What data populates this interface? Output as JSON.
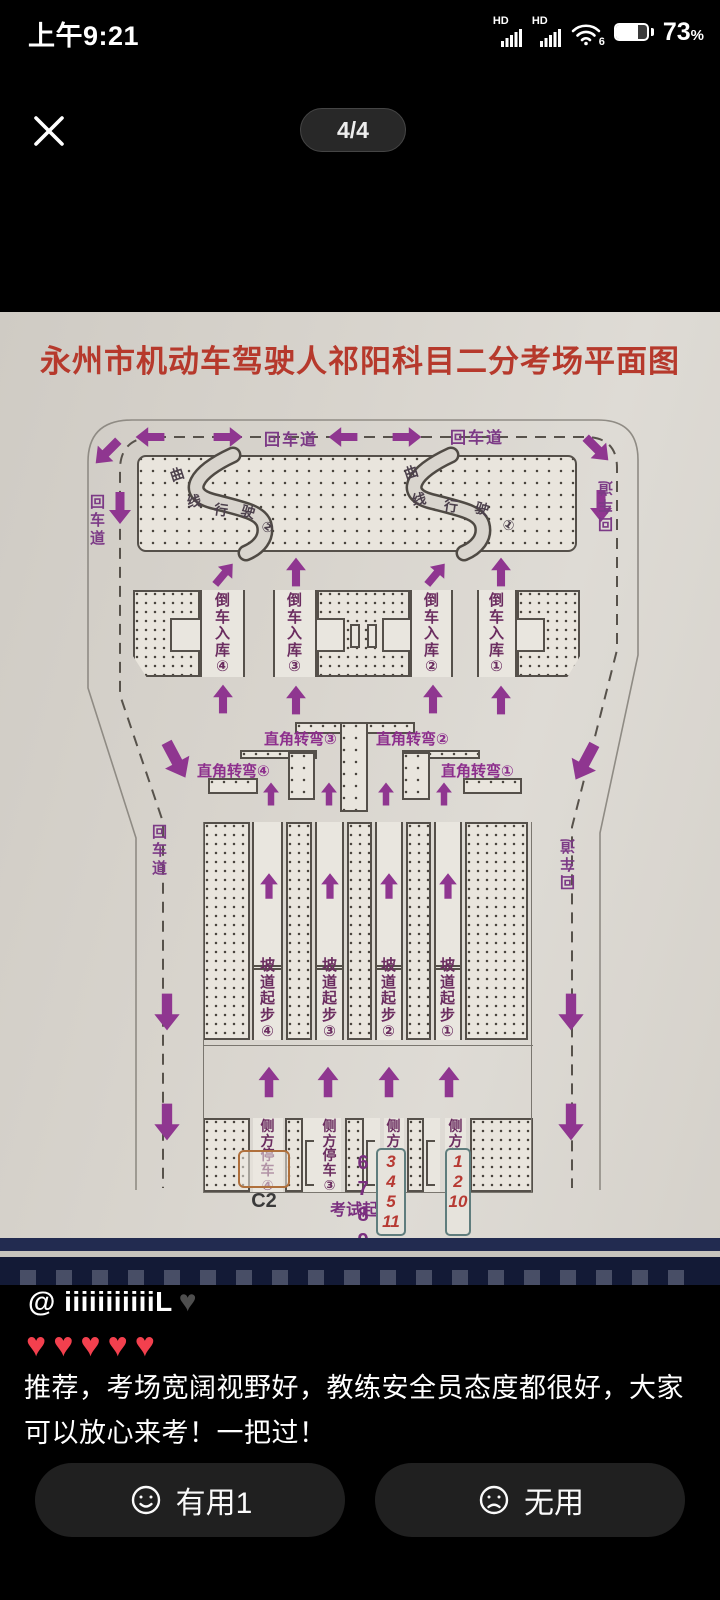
{
  "status_bar": {
    "time": "上午9:21",
    "hd": "HD",
    "wifi_gen": "6",
    "battery_percent": "73",
    "percent_sign": "%"
  },
  "viewer": {
    "page_indicator": "4/4"
  },
  "map": {
    "title": "永州市机动车驾驶人祁阳科目二分考场平面图",
    "road_label": "回车道",
    "curve": {
      "chars": [
        "曲",
        "线",
        "行",
        "驶"
      ],
      "num_left": "②",
      "num_right": "①"
    },
    "reverse_parking": {
      "labels": [
        "倒车入库④",
        "倒车入库③",
        "倒车入库②",
        "倒车入库①"
      ]
    },
    "right_angle": {
      "labels": [
        "直角转弯④",
        "直角转弯③",
        "直角转弯②",
        "直角转弯①"
      ]
    },
    "ramp": {
      "labels": [
        "坡道起步④",
        "坡道起步③",
        "坡道起步②",
        "坡道起步①"
      ]
    },
    "side_parking": {
      "labels": [
        "侧方停车④",
        "侧方停车③",
        "侧方停车②",
        "侧方停车①"
      ]
    },
    "bottom": {
      "c2": "C2",
      "queue": [
        "6",
        "7",
        "8",
        "9"
      ],
      "start_label": "考试起点",
      "box1": [
        "3",
        "4",
        "5",
        "11"
      ],
      "box2": [
        "1",
        "2",
        "10"
      ]
    }
  },
  "caption": {
    "username": "@ iiiiiiiiiiiL",
    "username_heart": "♥",
    "hearts": "♥♥♥♥♥",
    "review": "推荐，考场宽阔视野好，教练安全员态度都很好，大家可以放心来考！一把过！"
  },
  "actions": {
    "useful": "有用1",
    "useless": "无用"
  },
  "colors": {
    "accent_purple": "#8f3690",
    "title_red": "#b6392c",
    "heart_red": "#f3404e",
    "map_bg": "#d8d4cd",
    "banner_navy": "#222b50"
  }
}
